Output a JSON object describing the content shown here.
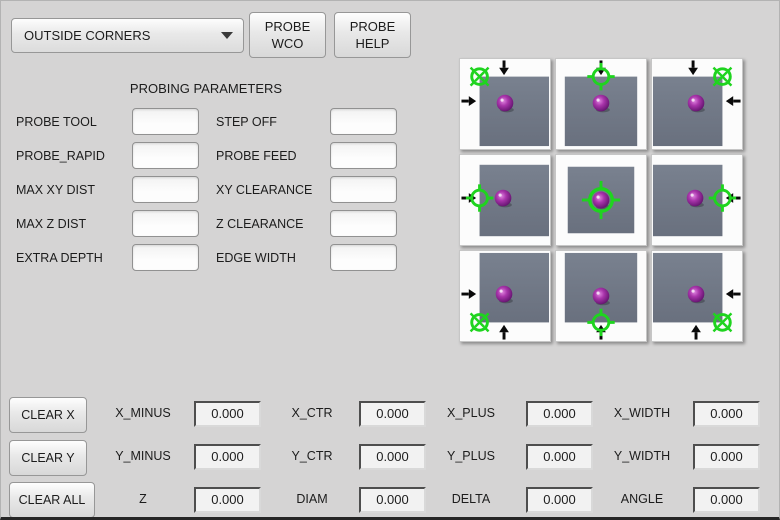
{
  "toolbar": {
    "mode_select": {
      "value": "OUTSIDE CORNERS"
    },
    "probe_wco": {
      "line1": "PROBE",
      "line2": "WCO"
    },
    "probe_help": {
      "line1": "PROBE",
      "line2": "HELP"
    }
  },
  "parameters": {
    "title": "PROBING PARAMETERS",
    "rows": [
      {
        "left_label": "PROBE TOOL",
        "left_value": "",
        "right_label": "STEP OFF",
        "right_value": ""
      },
      {
        "left_label": "PROBE_RAPID",
        "left_value": "",
        "right_label": "PROBE FEED",
        "right_value": ""
      },
      {
        "left_label": "MAX XY DIST",
        "left_value": "",
        "right_label": "XY CLEARANCE",
        "right_value": ""
      },
      {
        "left_label": "MAX Z DIST",
        "left_value": "",
        "right_label": "Z CLEARANCE",
        "right_value": ""
      },
      {
        "left_label": "EXTRA DEPTH",
        "left_value": "",
        "right_label": "EDGE WIDTH",
        "right_value": ""
      }
    ]
  },
  "probe_grid": {
    "colors": {
      "workpiece_top": "#79818f",
      "workpiece_bottom": "#69707e",
      "target": "#1fd41f",
      "arrow": "#0a0a0a",
      "sphere_hi": "#df85df",
      "sphere_mid": "#a935ab",
      "sphere_dark": "#6d1877",
      "sphere_edge": "#3c0c45"
    },
    "cells": [
      {
        "id": "top-left-corner",
        "square": [
          20,
          18,
          71,
          71
        ],
        "sphere": [
          46,
          45
        ],
        "target": [
          20,
          18
        ],
        "style": "corner",
        "arrows": [
          {
            "dir": "down",
            "at": 45
          },
          {
            "dir": "right",
            "at": 43
          }
        ]
      },
      {
        "id": "top-edge",
        "square": [
          9,
          18,
          74,
          71
        ],
        "sphere": [
          46,
          45
        ],
        "target": [
          46,
          18
        ],
        "style": "edge",
        "arrows": [
          {
            "dir": "down",
            "at": 46
          }
        ]
      },
      {
        "id": "top-right-corner",
        "square": [
          1,
          18,
          71,
          71
        ],
        "sphere": [
          45,
          45
        ],
        "target": [
          72,
          18
        ],
        "style": "corner",
        "arrows": [
          {
            "dir": "down",
            "at": 42
          },
          {
            "dir": "left",
            "at": 43
          }
        ]
      },
      {
        "id": "left-edge",
        "square": [
          20,
          10,
          71,
          73
        ],
        "sphere": [
          44,
          44
        ],
        "target": [
          20,
          44
        ],
        "style": "edge",
        "arrows": [
          {
            "dir": "right",
            "at": 44
          }
        ]
      },
      {
        "id": "center",
        "square": [
          12,
          12,
          68,
          68
        ],
        "sphere": [
          46,
          46
        ],
        "target": [
          46,
          46
        ],
        "style": "center",
        "arrows": []
      },
      {
        "id": "right-edge",
        "square": [
          1,
          10,
          71,
          73
        ],
        "sphere": [
          44,
          44
        ],
        "target": [
          72,
          44
        ],
        "style": "edge",
        "arrows": [
          {
            "dir": "left",
            "at": 44
          }
        ]
      },
      {
        "id": "bottom-left-corner",
        "square": [
          20,
          2,
          71,
          71
        ],
        "sphere": [
          45,
          44
        ],
        "target": [
          20,
          73
        ],
        "style": "corner",
        "arrows": [
          {
            "dir": "right",
            "at": 44
          },
          {
            "dir": "up",
            "at": 45
          }
        ]
      },
      {
        "id": "bottom-edge",
        "square": [
          9,
          2,
          74,
          71
        ],
        "sphere": [
          46,
          46
        ],
        "target": [
          46,
          73
        ],
        "style": "edge",
        "arrows": [
          {
            "dir": "up",
            "at": 46
          }
        ]
      },
      {
        "id": "bottom-right-corner",
        "square": [
          1,
          2,
          71,
          71
        ],
        "sphere": [
          45,
          44
        ],
        "target": [
          72,
          73
        ],
        "style": "corner",
        "arrows": [
          {
            "dir": "left",
            "at": 44
          },
          {
            "dir": "up",
            "at": 45
          }
        ]
      }
    ]
  },
  "results": {
    "buttons": {
      "clear_x": "CLEAR X",
      "clear_y": "CLEAR Y",
      "clear_all": "CLEAR ALL"
    },
    "rows": [
      {
        "cells": [
          {
            "label": "X_MINUS",
            "value": "0.000"
          },
          {
            "label": "X_CTR",
            "value": "0.000"
          },
          {
            "label": "X_PLUS",
            "value": "0.000"
          },
          {
            "label": "X_WIDTH",
            "value": "0.000"
          }
        ]
      },
      {
        "cells": [
          {
            "label": "Y_MINUS",
            "value": "0.000"
          },
          {
            "label": "Y_CTR",
            "value": "0.000"
          },
          {
            "label": "Y_PLUS",
            "value": "0.000"
          },
          {
            "label": "Y_WIDTH",
            "value": "0.000"
          }
        ]
      },
      {
        "cells": [
          {
            "label": "Z",
            "value": "0.000"
          },
          {
            "label": "DIAM",
            "value": "0.000"
          },
          {
            "label": "DELTA",
            "value": "0.000"
          },
          {
            "label": "ANGLE",
            "value": "0.000"
          }
        ]
      }
    ]
  }
}
